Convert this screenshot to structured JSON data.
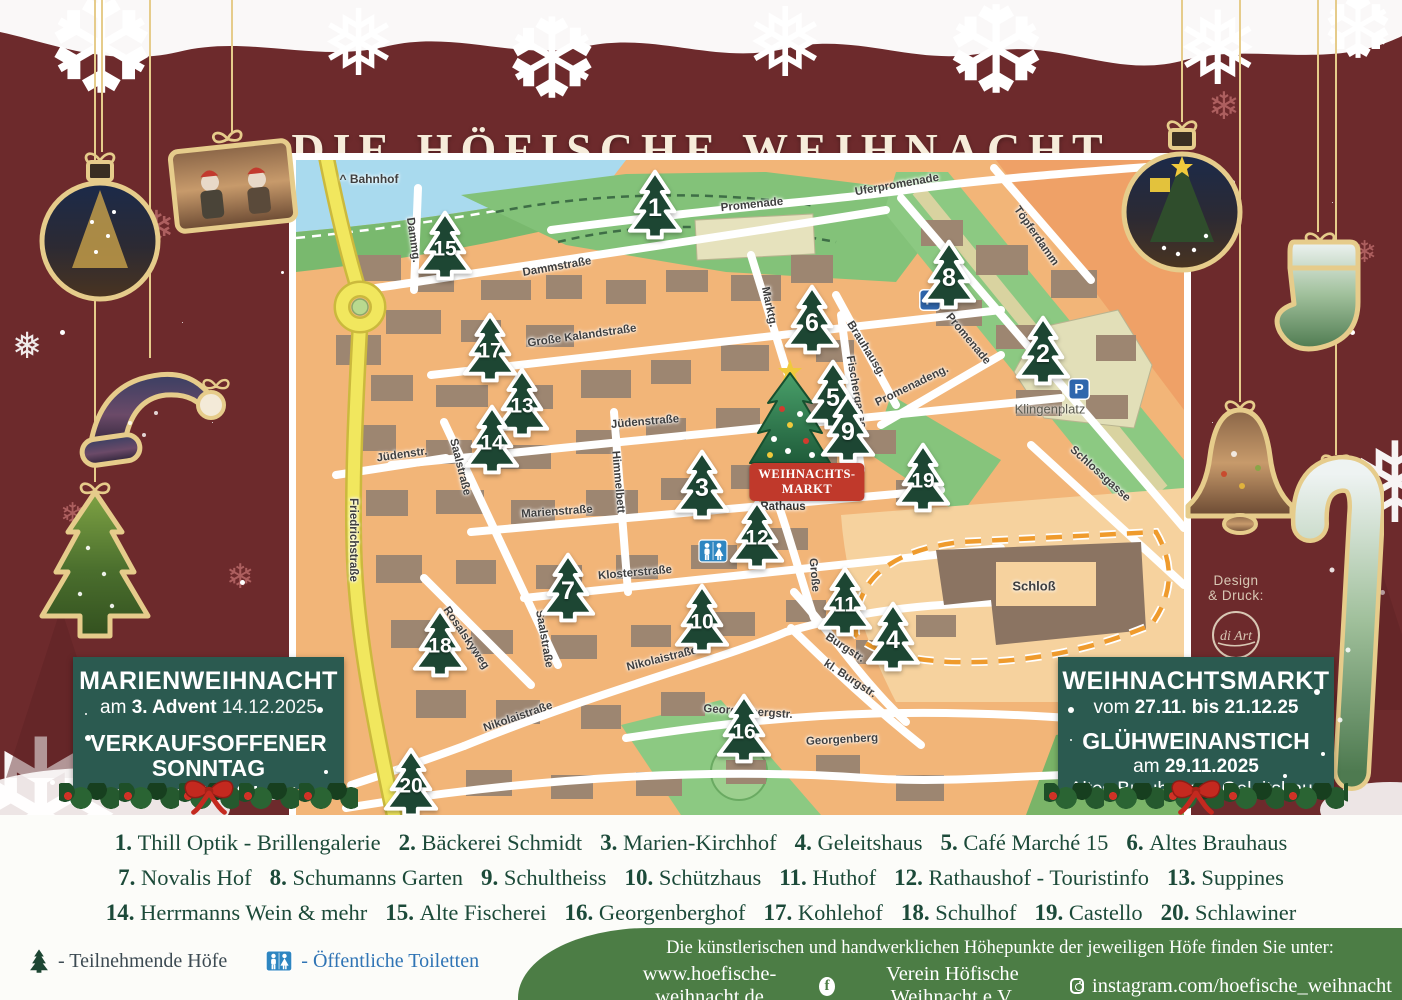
{
  "title": "DIE HÖFISCHE WEIHNACHT",
  "colors": {
    "background": "#6d2a2c",
    "accent_gold": "#e6cc8b",
    "box_green": "#2b5a50",
    "footer_green": "#4c7d45",
    "marker_green": "#1d4633",
    "market_red": "#c0392b",
    "legend_text": "#1c4a39",
    "map_land": "#f2b578",
    "water": "#a9daee",
    "road_yellow": "#f1e75e"
  },
  "map": {
    "bahnhof": "^ Bahnhof",
    "places": {
      "klingenplatz": "Klingenplatz",
      "rathaus": "Rathaus",
      "schloss": "Schloß",
      "weihnachtsmarkt_line1": "WEIHNACHTS-",
      "weihnachtsmarkt_line2": "MARKT",
      "parking": "P"
    },
    "streets": [
      {
        "t": "Dammg.",
        "x": 117,
        "y": 80,
        "r": 82
      },
      {
        "t": "Dammstraße",
        "x": 261,
        "y": 107,
        "r": -10
      },
      {
        "t": "Promenade",
        "x": 456,
        "y": 45,
        "r": -6
      },
      {
        "t": "Uferpromenade",
        "x": 601,
        "y": 25,
        "r": -10
      },
      {
        "t": "Töpferdamm",
        "x": 740,
        "y": 76,
        "r": 55
      },
      {
        "t": "Große Kalandstraße",
        "x": 286,
        "y": 176,
        "r": -8
      },
      {
        "t": "Marktg.",
        "x": 473,
        "y": 147,
        "r": 78
      },
      {
        "t": "Brauhausg.",
        "x": 570,
        "y": 189,
        "r": 58
      },
      {
        "t": "Fischergasse",
        "x": 560,
        "y": 232,
        "r": 80
      },
      {
        "t": "Promenadeng.",
        "x": 616,
        "y": 226,
        "r": -26
      },
      {
        "t": "Promenade",
        "x": 672,
        "y": 179,
        "r": 50
      },
      {
        "t": "Jüdenstraße",
        "x": 349,
        "y": 262,
        "r": -5
      },
      {
        "t": "Jüdenstr.",
        "x": 106,
        "y": 295,
        "r": -8
      },
      {
        "t": "Saalstraße",
        "x": 164,
        "y": 307,
        "r": 76
      },
      {
        "t": "Himmelbett",
        "x": 322,
        "y": 322,
        "r": 85
      },
      {
        "t": "Schlossgasse",
        "x": 804,
        "y": 314,
        "r": 42
      },
      {
        "t": "Marienstraße",
        "x": 261,
        "y": 352,
        "r": -4
      },
      {
        "t": "Friedrichstraße",
        "x": 57,
        "y": 380,
        "r": 90
      },
      {
        "t": "Klosterstraße",
        "x": 339,
        "y": 413,
        "r": -5
      },
      {
        "t": "Rosalskyweg",
        "x": 170,
        "y": 478,
        "r": 56
      },
      {
        "t": "Saalstraße",
        "x": 248,
        "y": 479,
        "r": 80
      },
      {
        "t": "Nikolaistraße",
        "x": 366,
        "y": 499,
        "r": -14
      },
      {
        "t": "Nikolaistraße",
        "x": 222,
        "y": 557,
        "r": -19
      },
      {
        "t": "Große",
        "x": 518,
        "y": 415,
        "r": 85
      },
      {
        "t": "Burgstr.",
        "x": 549,
        "y": 488,
        "r": 33
      },
      {
        "t": "kl. Burgstr.",
        "x": 554,
        "y": 519,
        "r": 33
      },
      {
        "t": "Georgenbergstr.",
        "x": 452,
        "y": 552,
        "r": 4
      },
      {
        "t": "Georgenberg",
        "x": 546,
        "y": 580,
        "r": -3
      }
    ],
    "markers": [
      {
        "n": "1",
        "x": 359,
        "y": 46
      },
      {
        "n": "2",
        "x": 747,
        "y": 192
      },
      {
        "n": "3",
        "x": 406,
        "y": 326
      },
      {
        "n": "4",
        "x": 597,
        "y": 478
      },
      {
        "n": "5",
        "x": 537,
        "y": 236
      },
      {
        "n": "6",
        "x": 516,
        "y": 161
      },
      {
        "n": "7",
        "x": 272,
        "y": 429
      },
      {
        "n": "8",
        "x": 653,
        "y": 116
      },
      {
        "n": "9",
        "x": 552,
        "y": 270
      },
      {
        "n": "10",
        "x": 406,
        "y": 460
      },
      {
        "n": "11",
        "x": 549,
        "y": 443
      },
      {
        "n": "12",
        "x": 461,
        "y": 376
      },
      {
        "n": "13",
        "x": 226,
        "y": 244
      },
      {
        "n": "14",
        "x": 196,
        "y": 281
      },
      {
        "n": "15",
        "x": 149,
        "y": 87
      },
      {
        "n": "16",
        "x": 448,
        "y": 570
      },
      {
        "n": "17",
        "x": 194,
        "y": 189
      },
      {
        "n": "18",
        "x": 144,
        "y": 484
      },
      {
        "n": "19",
        "x": 627,
        "y": 319
      },
      {
        "n": "20",
        "x": 115,
        "y": 624
      }
    ]
  },
  "left_box": {
    "title": "MARIENWEIHNACHT",
    "line2_pre": "am",
    "line2_bold": "3. Advent",
    "line2_date": "14.12.2025",
    "line3a": "VERKAUFSOFFENER",
    "line3b": "SONNTAG",
    "line4_pre": "am",
    "line4_bold": "1. und 3. Advent"
  },
  "right_box": {
    "title": "WEIHNACHTSMARKT",
    "line2_pre": "vom",
    "line2_bold": "27.11. bis 21.12.25",
    "line3": "GLÜHWEINANSTICH",
    "line4_pre": "am",
    "line4_bold": "29.11.2025",
    "line5": "Altes Brauhaus & Geleitshaus"
  },
  "legend": {
    "rows": [
      [
        {
          "n": "1.",
          "name": "Thill Optik - Brillengalerie"
        },
        {
          "n": "2.",
          "name": "Bäckerei Schmidt"
        },
        {
          "n": "3.",
          "name": "Marien-Kirchhof"
        },
        {
          "n": "4.",
          "name": "Geleitshaus"
        },
        {
          "n": "5.",
          "name": "Café Marché 15"
        },
        {
          "n": "6.",
          "name": "Altes Brauhaus"
        }
      ],
      [
        {
          "n": "7.",
          "name": "Novalis Hof"
        },
        {
          "n": "8.",
          "name": "Schumanns Garten"
        },
        {
          "n": "9.",
          "name": "Schultheiss"
        },
        {
          "n": "10.",
          "name": "Schützhaus"
        },
        {
          "n": "11.",
          "name": "Huthof"
        },
        {
          "n": "12.",
          "name": "Rathaushof - Touristinfo"
        },
        {
          "n": "13.",
          "name": "Suppines"
        }
      ],
      [
        {
          "n": "14.",
          "name": "Herrmanns Wein & mehr"
        },
        {
          "n": "15.",
          "name": "Alte Fischerei"
        },
        {
          "n": "16.",
          "name": "Georgenberghof"
        },
        {
          "n": "17.",
          "name": "Kohlehof"
        },
        {
          "n": "18.",
          "name": "Schulhof"
        },
        {
          "n": "19.",
          "name": "Castello"
        },
        {
          "n": "20.",
          "name": "Schlawiner"
        }
      ]
    ]
  },
  "footer": {
    "tree_label": "- Teilnehmende Höfe",
    "wc_label": "- Öffentliche Toiletten",
    "info": "Die künstlerischen und handwerklichen Höhepunkte der jeweiligen Höfe finden Sie unter:",
    "website": "www.hoefische-weihnacht.de",
    "facebook": "Verein Höfische Weihnacht e.V.",
    "instagram": "instagram.com/hoefische_weihnacht",
    "facebook_letter": "f"
  },
  "credit": {
    "line1": "Design",
    "line2": "& Druck:",
    "logo": "di Art"
  }
}
